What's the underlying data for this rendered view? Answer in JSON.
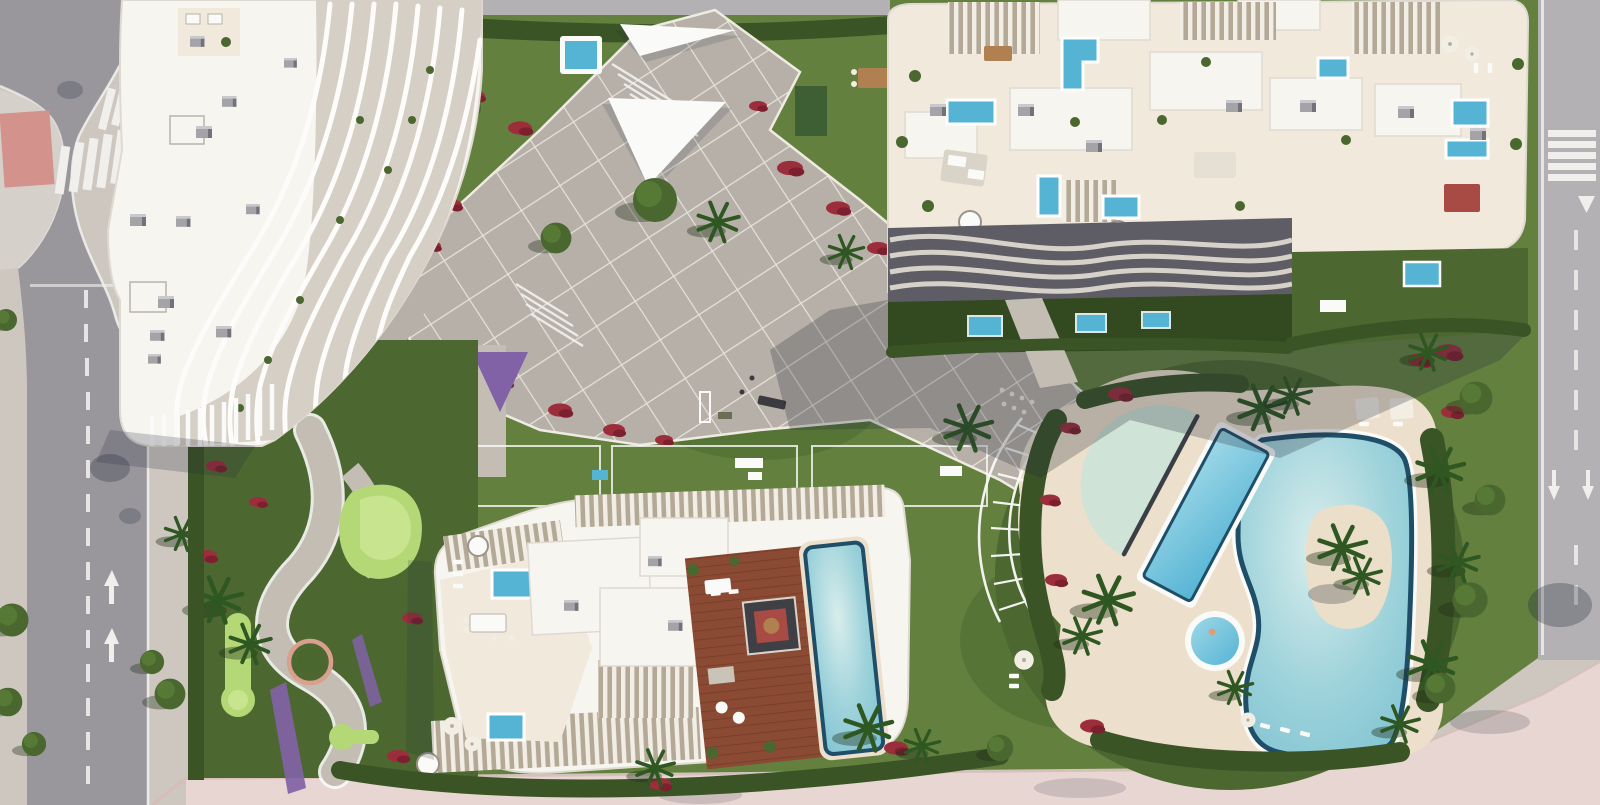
{
  "scene": {
    "type": "aerial-architectural-render",
    "description": "Top-down aerial 3D rendering of a Mediterranean residential development: three white organic-curved apartment buildings with rooftop terraces and private plunge pools, a central paved plaza with lawns and flower beds, a lagoon-style community pool with sand island, a lap pool, kids pool and jacuzzi, a putting-green garden, perimeter hedges with palm trees, surrounding asphalt roads with zebra crossings and a pink pedestrian promenade",
    "regions": [
      {
        "name": "building-a",
        "label": "North-west apartment building with wavy balcony fins"
      },
      {
        "name": "building-b",
        "label": "North-east apartment building with rooftop pools and wavy balconies"
      },
      {
        "name": "building-c",
        "label": "South apartment building with wooden deck and rooftop pool"
      },
      {
        "name": "central-plaza",
        "label": "Paved central plaza with diagonal walkways"
      },
      {
        "name": "pool-complex",
        "label": "Lagoon pool area with sand island, lap pool, kids pool and jacuzzi"
      },
      {
        "name": "putting-garden",
        "label": "Putting green garden with winding path"
      },
      {
        "name": "left-avenue",
        "label": "Curved avenue with zebra crossings (west)"
      },
      {
        "name": "right-road",
        "label": "Straight road with crossing (east)"
      },
      {
        "name": "pink-promenade",
        "label": "Pink paved promenade (south)"
      },
      {
        "name": "perimeter-hedges",
        "label": "Dense hedges, palms and red flower beds"
      }
    ]
  },
  "palette": {
    "road": "#9a979c",
    "road-light": "#b3b1b4",
    "sidewalk": "#cdc7c0",
    "island-pale": "#d6d0ca",
    "marking": "#f0efec",
    "red-crossing": "#d4928c",
    "pink-walk": "#e8d6d2",
    "pink-walk-deep": "#d8bcb7",
    "community-lawn": "#63803f",
    "lawn-dark": "#4c6830",
    "lawn-shadow": "#33491f",
    "putting": "#b5d877",
    "putting-light": "#c8e48e",
    "hedge": "#3b5426",
    "tree-green": "#49672e",
    "tree-light": "#567a36",
    "palm-green": "#2e5722",
    "flower-red": "#9c2e3c",
    "flower-dark": "#7c1f2e",
    "flower-purple": "#8162a6",
    "plaza": "#b6b0a8",
    "plaza-joint": "#efebe3",
    "path-gray": "#c3bdb4",
    "deck-cream": "#ecdfcb",
    "terrace-cream": "#f0e9dc",
    "building-white": "#f7f5f0",
    "building-edge": "#dfdad1",
    "fin-zone": "#d5cfc5",
    "balcony-dark": "#5e5d66",
    "balcony-line": "#d6d1c9",
    "hvac": "#a3a3a8",
    "hvac-dark": "#72727a",
    "pool-blue": "#55b4d4",
    "pool-rim": "#1f4f68",
    "lagoon-light": "#d8edec",
    "lagoon-mid": "#9fd3db",
    "lagoon-deep": "#7fc3d2",
    "kids-pool": "#cfe3d6",
    "chord-dark": "#3a3f45",
    "wood": "#8a4a33",
    "wood-dark": "#713a28",
    "island-sand": "#ecdfc9",
    "shadow-col": "#232a3a",
    "white": "#fafaf8",
    "umbrella": "#f2eee4",
    "furniture-brown": "#b08050",
    "shed-green": "#3e5e33",
    "rug-red": "#a84b44"
  }
}
